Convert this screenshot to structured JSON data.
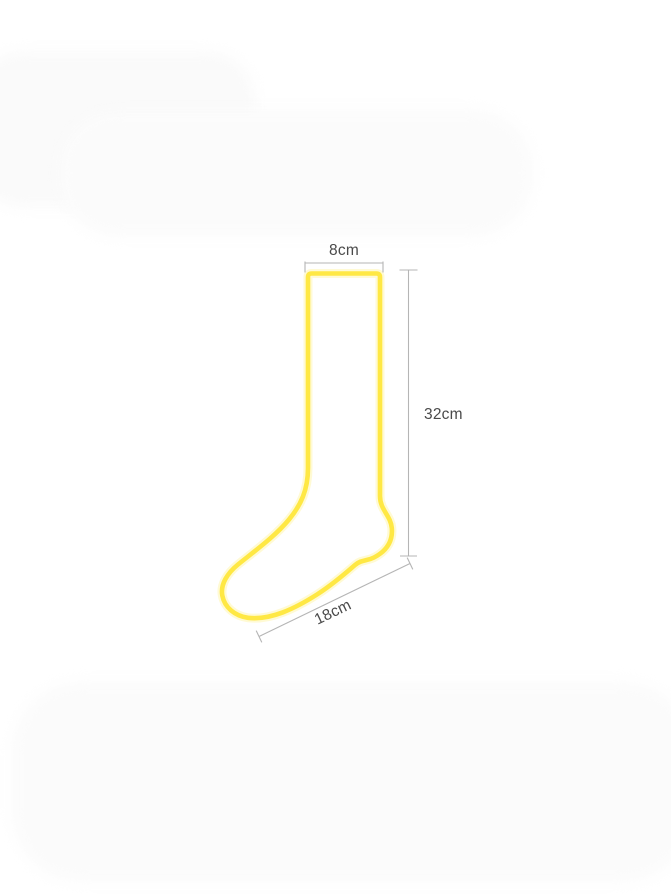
{
  "measurements": {
    "cuff_width": "8cm",
    "leg_height": "32cm",
    "foot_length": "18cm"
  },
  "colors": {
    "sock_outline": "#ffe844",
    "sock_outline_glow": "#fff5b0",
    "dimension_line": "#b5b5b5",
    "label_text": "#4a4a4a",
    "background": "#ffffff",
    "background_artifact": "#fbfbfb"
  }
}
